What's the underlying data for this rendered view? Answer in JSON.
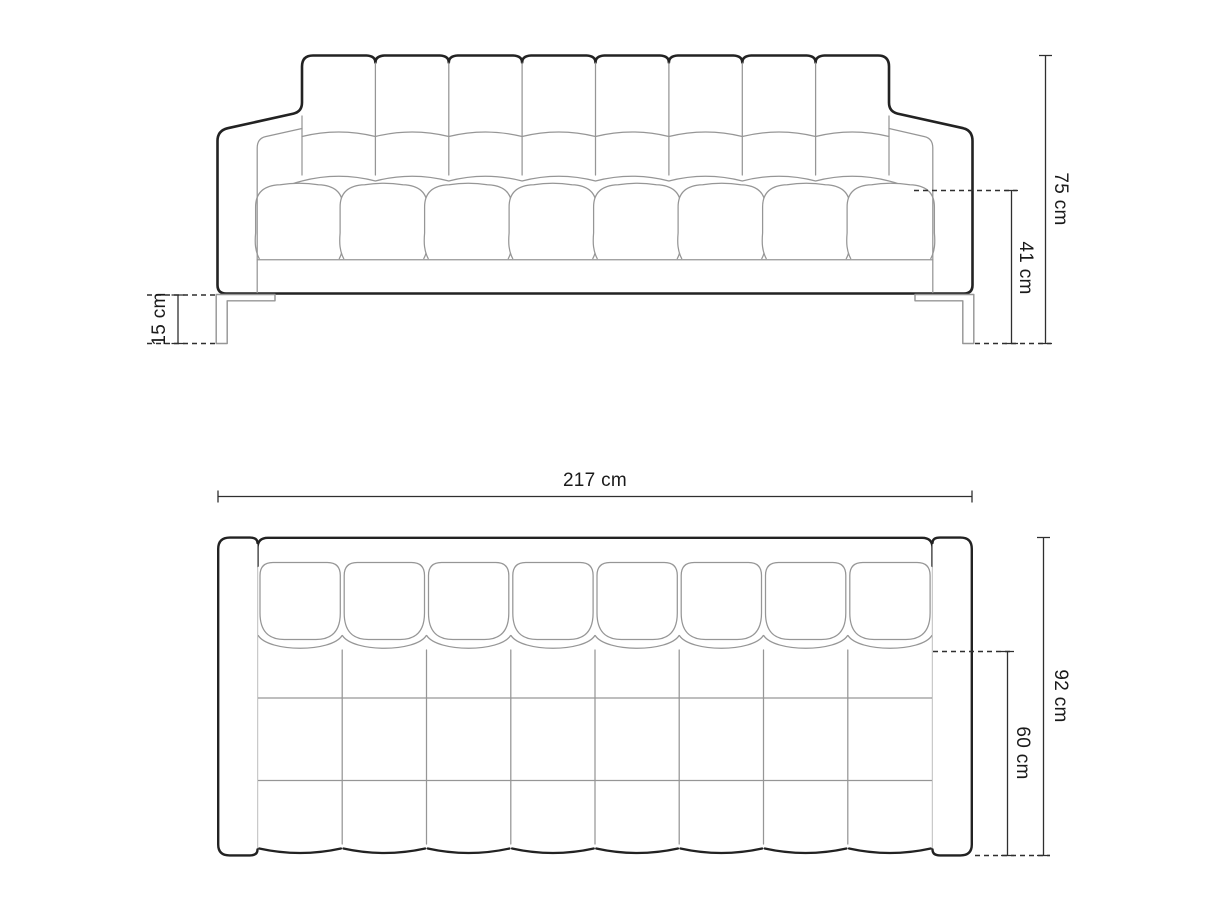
{
  "front_view": {
    "overall_height": {
      "label": "75 cm",
      "value": 75,
      "unit": "cm"
    },
    "seat_height": {
      "label": "41 cm",
      "value": 41,
      "unit": "cm"
    },
    "leg_height": {
      "label": "15 cm",
      "value": 15,
      "unit": "cm"
    }
  },
  "top_view": {
    "overall_width": {
      "label": "217 cm",
      "value": 217,
      "unit": "cm"
    },
    "overall_depth": {
      "label": "92 cm",
      "value": 92,
      "unit": "cm"
    },
    "seat_depth": {
      "label": "60 cm",
      "value": 60,
      "unit": "cm"
    }
  },
  "colors": {
    "background": "#ffffff",
    "outline": "#222222",
    "detail_line": "#969696",
    "dimension_line": "#2f2f2f",
    "label_text": "#1a1a1a"
  }
}
